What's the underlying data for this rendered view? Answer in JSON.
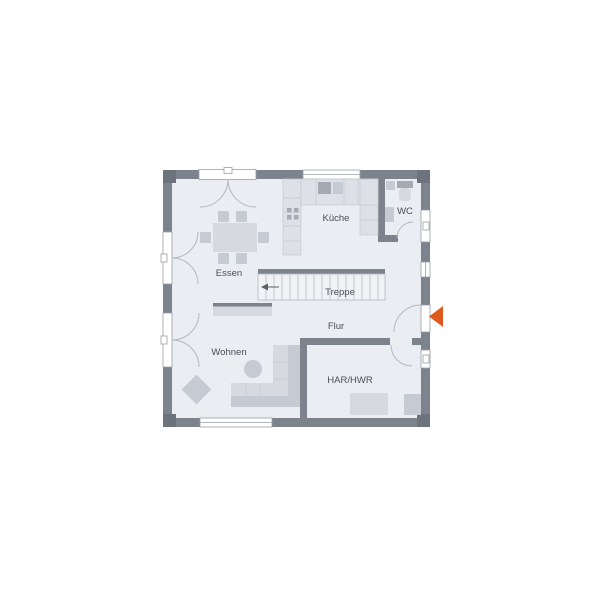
{
  "labels": {
    "essen": "Essen",
    "kueche": "Küche",
    "wc": "WC",
    "treppe": "Treppe",
    "flur": "Flur",
    "wohnen": "Wohnen",
    "har_hwr": "HAR/HWR"
  },
  "colors": {
    "wall": "#7d838d",
    "wall_dark": "#6d737d",
    "floor": "#eaedf2",
    "opening": "#ffffff",
    "opening_border": "#9aa0a8",
    "line": "#b4b9c1",
    "counter": "#dde1e7",
    "counter_line": "#c6cad1",
    "furniture_light": "#d6d9df",
    "furniture_mid": "#c6cad2",
    "furniture_dark": "#a4a9b2",
    "stair_fill": "#f0f2f6",
    "stair_line": "#b9bec6",
    "stair_arrow": "#5a5f67",
    "accent": "#dc5a1e",
    "text": "#4a4f57"
  }
}
